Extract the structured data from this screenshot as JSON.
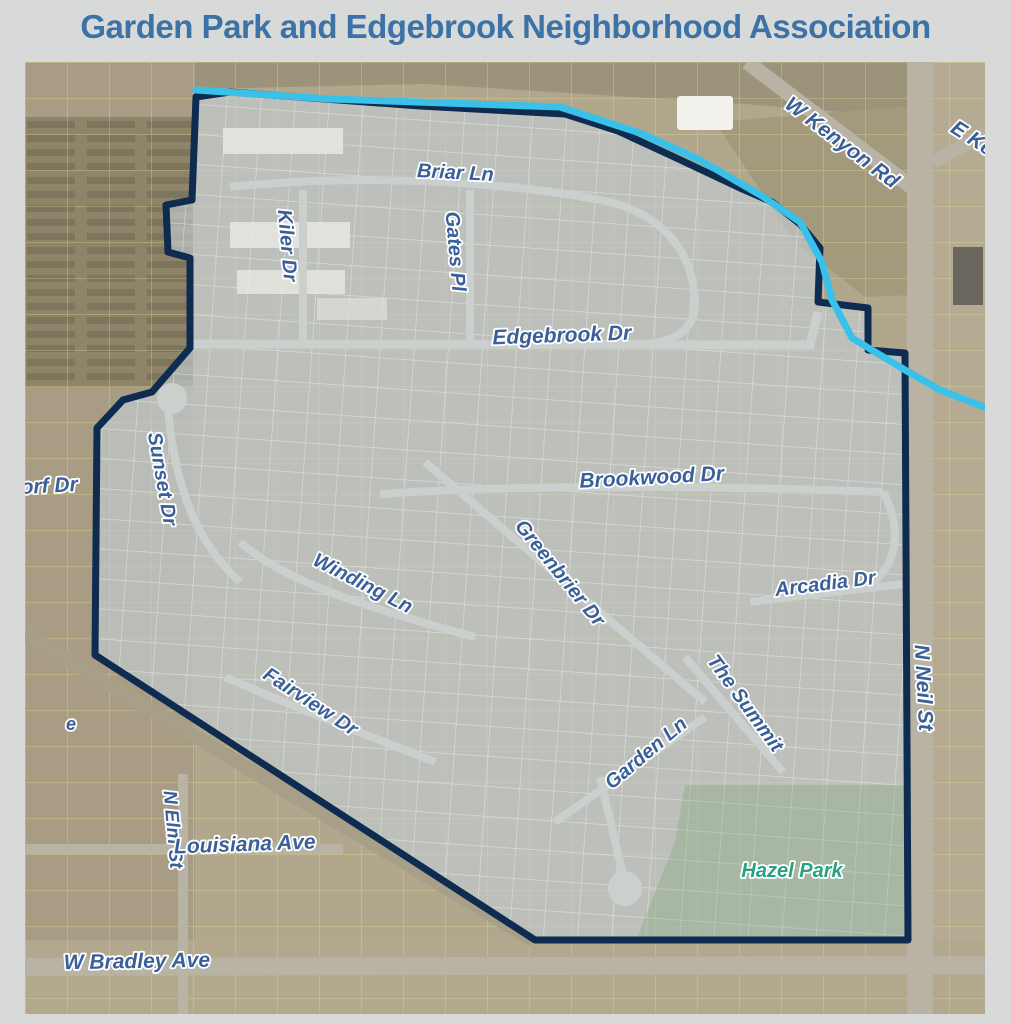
{
  "page": {
    "title": "Garden Park and Edgebrook Neighborhood Association",
    "title_color": "#3c72a6",
    "background": "#d8dad9"
  },
  "map": {
    "colors": {
      "aerial_base": "#b1a78d",
      "aerial_dark": "#9c8f74",
      "neighborhood_overlay": "rgba(197,206,214,0.62)",
      "boundary": "#0e2b50",
      "creek": "#39c1ea",
      "road_grey": "#b8b3a4",
      "railroad": "#a89f88",
      "street_inner": "#cbcfcd",
      "label_blue": "#3b5f99",
      "label_green": "#2aa183",
      "parcel_yellow": "#e9e48f",
      "parcel_white": "#eef1f2",
      "park_fill": "rgba(116,162,106,0.28)"
    },
    "boundary": {
      "points": "171,35 205,30 395,44 540,52 593,69 647,94 715,126 747,140 775,162 795,186 793,240 843,246 843,288 880,291 883,878 510,878 70,593 72,366 98,338 127,330 165,286 165,196 143,190 141,143 167,138",
      "stroke_width": 7
    },
    "creek": {
      "points": "171,28 305,37 535,45 615,71 675,98 737,134 775,160 797,200 807,238 827,276 880,308 915,328 959,345",
      "stroke_width": 7
    },
    "park": {
      "name": "Hazel Park",
      "points": "660,723 880,723 880,876 612,876 650,780"
    },
    "roads": [
      {
        "id": "n-neil-st",
        "layer": "outer",
        "path": "M895,0 L895,952",
        "width": 26,
        "color": "road_grey"
      },
      {
        "id": "w-kenyon-rd",
        "layer": "outer",
        "path": "M722,0 L893,130",
        "width": 15,
        "color": "road_grey"
      },
      {
        "id": "e-kenyon-rd",
        "layer": "outer",
        "path": "M908,100 L960,72",
        "width": 13,
        "color": "road_grey"
      },
      {
        "id": "w-bradley-ave",
        "layer": "outer",
        "path": "M0,905 L960,903",
        "width": 18,
        "color": "road_grey"
      },
      {
        "id": "louisiana-ave",
        "layer": "outer",
        "path": "M0,787 L318,787",
        "width": 10,
        "color": "road_grey"
      },
      {
        "id": "n-elm-st",
        "layer": "outer",
        "path": "M158,712 L158,952",
        "width": 10,
        "color": "road_grey"
      },
      {
        "id": "railroad-diagonal",
        "layer": "outer",
        "path": "M0,572 L508,878",
        "width": 14,
        "color": "railroad"
      },
      {
        "id": "briar-ln",
        "layer": "inner",
        "path": "M205,125 C330,112 480,118 585,140 C640,155 668,190 670,240 C670,268 650,280 620,282",
        "width": 8,
        "color": "street_inner"
      },
      {
        "id": "kiler-dr",
        "layer": "inner",
        "path": "M278,128 L278,280",
        "width": 8,
        "color": "street_inner"
      },
      {
        "id": "gates-pl",
        "layer": "inner",
        "path": "M445,128 L445,280",
        "width": 8,
        "color": "street_inner"
      },
      {
        "id": "edgebrook-dr",
        "layer": "inner",
        "path": "M150,282 L785,283 L793,250",
        "width": 9,
        "color": "street_inner"
      },
      {
        "id": "sunset-dr",
        "layer": "inner",
        "path": "M142,336 C148,420 170,480 215,520",
        "width": 8,
        "color": "street_inner"
      },
      {
        "id": "brookwood-dr",
        "layer": "inner",
        "path": "M355,432 C500,422 700,424 858,430",
        "width": 8,
        "color": "street_inner"
      },
      {
        "id": "greenbrier-dr",
        "layer": "inner",
        "path": "M400,400 L680,640",
        "width": 8,
        "color": "street_inner"
      },
      {
        "id": "winding-ln",
        "layer": "inner",
        "path": "M215,480 C260,520 340,545 450,575",
        "width": 8,
        "color": "street_inner"
      },
      {
        "id": "arcadia-dr",
        "layer": "inner",
        "path": "M725,540 L878,522",
        "width": 8,
        "color": "street_inner"
      },
      {
        "id": "fairview-dr",
        "layer": "inner",
        "path": "M200,615 C280,650 360,680 410,700",
        "width": 8,
        "color": "street_inner"
      },
      {
        "id": "the-summit",
        "layer": "inner",
        "path": "M660,595 L758,710",
        "width": 8,
        "color": "street_inner"
      },
      {
        "id": "garden-ln",
        "layer": "inner",
        "path": "M530,760 L680,655",
        "width": 8,
        "color": "street_inner"
      },
      {
        "id": "garden-ln-stub",
        "layer": "inner",
        "path": "M600,822 L575,715",
        "width": 8,
        "color": "street_inner"
      },
      {
        "id": "garden-ln-culdesac",
        "layer": "inner",
        "path": "M600,826 L600,827",
        "width": 34,
        "color": "street_inner",
        "cap": "round"
      },
      {
        "id": "edgebrook-culdesac",
        "layer": "inner",
        "path": "M147,336 L147,337",
        "width": 30,
        "color": "street_inner",
        "cap": "round"
      },
      {
        "id": "right-loop",
        "layer": "inner",
        "path": "M858,430 C880,470 870,510 840,525",
        "width": 8,
        "color": "street_inner"
      }
    ],
    "street_labels": [
      {
        "id": "briar-ln",
        "text": "Briar Ln",
        "x": 430,
        "y": 117,
        "rotate": 3,
        "size": 20,
        "color": "blue"
      },
      {
        "id": "kiler-dr",
        "text": "Kiler Dr",
        "x": 256,
        "y": 184,
        "rotate": 85,
        "size": 20,
        "color": "blue"
      },
      {
        "id": "gates-pl",
        "text": "Gates Pl",
        "x": 424,
        "y": 190,
        "rotate": 85,
        "size": 20,
        "color": "blue"
      },
      {
        "id": "edgebrook-dr",
        "text": "Edgebrook Dr",
        "x": 537,
        "y": 280,
        "rotate": -2,
        "size": 21,
        "color": "blue"
      },
      {
        "id": "sunset-dr",
        "text": "Sunset Dr",
        "x": 131,
        "y": 418,
        "rotate": 80,
        "size": 20,
        "color": "blue"
      },
      {
        "id": "orf-dr",
        "text": "orf Dr",
        "x": -4,
        "y": 432,
        "rotate": -3,
        "size": 21,
        "color": "blue",
        "anchor": "start"
      },
      {
        "id": "brookwood-dr",
        "text": "Brookwood Dr",
        "x": 627,
        "y": 422,
        "rotate": -3,
        "size": 21,
        "color": "blue"
      },
      {
        "id": "greenbrier-dr",
        "text": "Greenbrier Dr",
        "x": 530,
        "y": 515,
        "rotate": 51,
        "size": 20,
        "color": "blue"
      },
      {
        "id": "winding-ln",
        "text": "Winding Ln",
        "x": 335,
        "y": 527,
        "rotate": 27,
        "size": 20,
        "color": "blue"
      },
      {
        "id": "arcadia-dr",
        "text": "Arcadia Dr",
        "x": 801,
        "y": 528,
        "rotate": -7,
        "size": 20,
        "color": "blue"
      },
      {
        "id": "fairview-dr",
        "text": "Fairview Dr",
        "x": 282,
        "y": 645,
        "rotate": 33,
        "size": 20,
        "color": "blue"
      },
      {
        "id": "the-summit",
        "text": "The Summit",
        "x": 715,
        "y": 645,
        "rotate": 54,
        "size": 20,
        "color": "blue"
      },
      {
        "id": "garden-ln",
        "text": "Garden Ln",
        "x": 625,
        "y": 696,
        "rotate": -40,
        "size": 20,
        "color": "blue"
      },
      {
        "id": "hazel-park",
        "text": "Hazel Park",
        "x": 767,
        "y": 815,
        "rotate": 0,
        "size": 20,
        "color": "green"
      },
      {
        "id": "w-kenyon-rd",
        "text": "W Kenyon Rd",
        "x": 813,
        "y": 86,
        "rotate": 37,
        "size": 21,
        "color": "blue"
      },
      {
        "id": "e-kenyon-rd",
        "text": "E Ke",
        "x": 944,
        "y": 82,
        "rotate": 33,
        "size": 21,
        "color": "blue"
      },
      {
        "id": "n-neil-st",
        "text": "N Neil St",
        "x": 892,
        "y": 626,
        "rotate": 87,
        "size": 21,
        "color": "blue"
      },
      {
        "id": "n-elm-st",
        "text": "N Elm St",
        "x": 142,
        "y": 768,
        "rotate": 85,
        "size": 19,
        "color": "blue"
      },
      {
        "id": "louisiana-ave",
        "text": "Louisiana Ave",
        "x": 220,
        "y": 789,
        "rotate": -2,
        "size": 21,
        "color": "blue"
      },
      {
        "id": "w-bradley-ave",
        "text": "W Bradley Ave",
        "x": 112,
        "y": 906,
        "rotate": -1,
        "size": 21,
        "color": "blue"
      },
      {
        "id": "partial-street-e",
        "text": "e",
        "x": 46,
        "y": 668,
        "rotate": 0,
        "size": 18,
        "color": "blue"
      }
    ]
  }
}
